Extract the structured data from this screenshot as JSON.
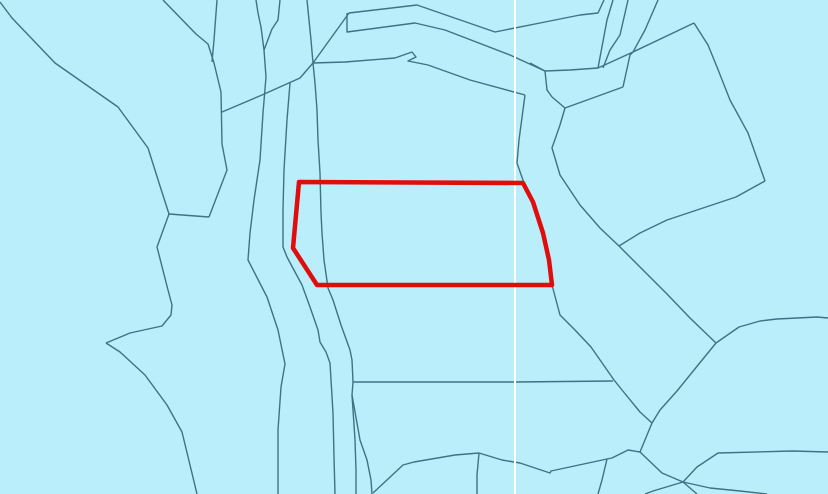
{
  "map": {
    "width": 828,
    "height": 494,
    "colors": {
      "water_background": "#b9eefa",
      "parcel_boundary": "#417284",
      "graticule_line": "#ffffff",
      "selected_parcel_outline": "#e00d0d"
    },
    "style": {
      "boundary_stroke_width": 1.4,
      "graticule_stroke_width": 2,
      "selected_stroke_width": 4.5
    },
    "graticule": {
      "type": "vertical-line",
      "x": 515,
      "y1": 0,
      "y2": 494
    },
    "selected_parcel": {
      "label": "highlighted-parcel",
      "points": [
        [
          299,
          182
        ],
        [
          523,
          183
        ],
        [
          533,
          202
        ],
        [
          543,
          233
        ],
        [
          549,
          260
        ],
        [
          552,
          285
        ],
        [
          317,
          285
        ],
        [
          293,
          248
        ]
      ]
    },
    "boundary_lines": [
      [
        [
          0,
          2
        ],
        [
          12,
          18
        ],
        [
          55,
          63
        ],
        [
          118,
          107
        ],
        [
          148,
          148
        ],
        [
          160,
          186
        ],
        [
          169,
          214
        ]
      ],
      [
        [
          169,
          214
        ],
        [
          209,
          217
        ]
      ],
      [
        [
          163,
          0
        ],
        [
          196,
          34
        ],
        [
          208,
          44
        ],
        [
          214,
          63
        ],
        [
          221,
          92
        ],
        [
          222,
          144
        ],
        [
          227,
          170
        ],
        [
          209,
          217
        ]
      ],
      [
        [
          217,
          0
        ],
        [
          214,
          40
        ],
        [
          212,
          62
        ]
      ],
      [
        [
          169,
          214
        ],
        [
          157,
          247
        ],
        [
          168,
          290
        ],
        [
          172,
          305
        ],
        [
          171,
          315
        ],
        [
          162,
          326
        ],
        [
          130,
          333
        ],
        [
          106,
          343
        ]
      ],
      [
        [
          106,
          343
        ],
        [
          120,
          352
        ],
        [
          145,
          375
        ],
        [
          167,
          405
        ],
        [
          182,
          432
        ],
        [
          190,
          465
        ],
        [
          197,
          494
        ]
      ],
      [
        [
          256,
          0
        ],
        [
          258,
          13
        ],
        [
          261,
          27
        ],
        [
          264,
          50
        ],
        [
          266,
          77
        ],
        [
          263,
          113
        ],
        [
          260,
          160
        ],
        [
          254,
          200
        ],
        [
          250,
          233
        ],
        [
          248,
          260
        ],
        [
          267,
          297
        ],
        [
          278,
          330
        ],
        [
          285,
          364
        ],
        [
          281,
          387
        ],
        [
          278,
          430
        ],
        [
          278,
          494
        ]
      ],
      [
        [
          280,
          0
        ],
        [
          278,
          20
        ],
        [
          272,
          29
        ],
        [
          264,
          50
        ]
      ],
      [
        [
          307,
          0
        ],
        [
          311,
          40
        ],
        [
          313,
          63
        ],
        [
          315,
          83
        ],
        [
          317,
          110
        ],
        [
          318,
          140
        ],
        [
          320,
          173
        ],
        [
          321,
          213
        ],
        [
          322,
          233
        ],
        [
          324,
          260
        ],
        [
          328,
          288
        ],
        [
          333,
          300
        ],
        [
          341,
          325
        ],
        [
          350,
          350
        ],
        [
          352,
          360
        ],
        [
          353,
          382
        ],
        [
          352,
          395
        ],
        [
          355,
          440
        ],
        [
          356,
          470
        ],
        [
          356,
          494
        ]
      ],
      [
        [
          352,
          395
        ],
        [
          360,
          440
        ],
        [
          367,
          460
        ],
        [
          371,
          480
        ],
        [
          372,
          494
        ]
      ],
      [
        [
          290,
          83
        ],
        [
          287,
          120
        ],
        [
          284,
          170
        ],
        [
          283,
          210
        ],
        [
          283,
          247
        ],
        [
          287,
          257
        ],
        [
          295,
          272
        ],
        [
          302,
          285
        ],
        [
          310,
          307
        ],
        [
          318,
          330
        ],
        [
          320,
          342
        ],
        [
          326,
          352
        ],
        [
          330,
          363
        ],
        [
          333,
          413
        ],
        [
          334,
          457
        ],
        [
          335,
          494
        ]
      ],
      [
        [
          222,
          112
        ],
        [
          262,
          95
        ],
        [
          300,
          78
        ],
        [
          313,
          63
        ],
        [
          349,
          13
        ],
        [
          417,
          5
        ],
        [
          495,
          32
        ],
        [
          540,
          23
        ],
        [
          580,
          15
        ],
        [
          598,
          13
        ],
        [
          604,
          0
        ]
      ],
      [
        [
          347,
          13
        ],
        [
          347,
          32
        ],
        [
          415,
          23
        ],
        [
          445,
          30
        ],
        [
          510,
          55
        ],
        [
          545,
          71
        ]
      ],
      [
        [
          545,
          71
        ],
        [
          570,
          70
        ],
        [
          598,
          68
        ]
      ],
      [
        [
          313,
          63
        ],
        [
          345,
          62
        ],
        [
          395,
          58
        ],
        [
          412,
          52
        ],
        [
          416,
          57
        ],
        [
          408,
          61
        ],
        [
          428,
          65
        ],
        [
          470,
          80
        ],
        [
          525,
          95
        ]
      ],
      [
        [
          525,
          95
        ],
        [
          519,
          140
        ],
        [
          517,
          163
        ],
        [
          524,
          183
        ],
        [
          533,
          205
        ],
        [
          543,
          237
        ],
        [
          550,
          262
        ],
        [
          552,
          285
        ]
      ],
      [
        [
          552,
          285
        ],
        [
          560,
          315
        ],
        [
          575,
          330
        ],
        [
          591,
          347
        ],
        [
          614,
          380
        ],
        [
          622,
          390
        ],
        [
          640,
          412
        ],
        [
          652,
          423
        ]
      ],
      [
        [
          530,
          63
        ],
        [
          545,
          71
        ]
      ],
      [
        [
          545,
          71
        ],
        [
          547,
          90
        ],
        [
          552,
          97
        ]
      ],
      [
        [
          552,
          97
        ],
        [
          565,
          108
        ]
      ],
      [
        [
          565,
          108
        ],
        [
          623,
          87
        ]
      ],
      [
        [
          623,
          87
        ],
        [
          630,
          55
        ],
        [
          633,
          52
        ]
      ],
      [
        [
          598,
          68
        ],
        [
          633,
          52
        ],
        [
          694,
          23
        ]
      ],
      [
        [
          613,
          0
        ],
        [
          607,
          20
        ],
        [
          598,
          68
        ]
      ],
      [
        [
          628,
          0
        ],
        [
          620,
          35
        ],
        [
          610,
          50
        ],
        [
          603,
          68
        ]
      ],
      [
        [
          658,
          0
        ],
        [
          645,
          30
        ],
        [
          633,
          52
        ]
      ],
      [
        [
          565,
          108
        ],
        [
          560,
          125
        ],
        [
          552,
          148
        ],
        [
          560,
          175
        ],
        [
          580,
          205
        ],
        [
          600,
          228
        ],
        [
          619,
          246
        ]
      ],
      [
        [
          694,
          23
        ],
        [
          708,
          45
        ],
        [
          717,
          67
        ],
        [
          730,
          100
        ],
        [
          748,
          133
        ],
        [
          765,
          181
        ]
      ],
      [
        [
          765,
          181
        ],
        [
          736,
          197
        ],
        [
          700,
          209
        ],
        [
          667,
          220
        ],
        [
          640,
          233
        ],
        [
          619,
          246
        ]
      ],
      [
        [
          619,
          246
        ],
        [
          645,
          272
        ],
        [
          667,
          294
        ],
        [
          690,
          318
        ],
        [
          716,
          343
        ]
      ],
      [
        [
          716,
          343
        ],
        [
          739,
          327
        ],
        [
          760,
          321
        ],
        [
          777,
          319
        ],
        [
          817,
          317
        ],
        [
          828,
          318
        ]
      ],
      [
        [
          716,
          343
        ],
        [
          694,
          370
        ],
        [
          677,
          391
        ],
        [
          660,
          410
        ],
        [
          652,
          423
        ]
      ],
      [
        [
          652,
          423
        ],
        [
          640,
          452
        ]
      ],
      [
        [
          640,
          452
        ],
        [
          628,
          450
        ],
        [
          612,
          458
        ],
        [
          607,
          459
        ],
        [
          551,
          471
        ],
        [
          550,
          473
        ],
        [
          520,
          463
        ],
        [
          502,
          460
        ],
        [
          479,
          453
        ]
      ],
      [
        [
          479,
          453
        ],
        [
          455,
          455
        ],
        [
          414,
          462
        ],
        [
          403,
          465
        ],
        [
          373,
          493
        ]
      ],
      [
        [
          479,
          453
        ],
        [
          477,
          475
        ],
        [
          477,
          494
        ]
      ],
      [
        [
          607,
          459
        ],
        [
          602,
          480
        ],
        [
          598,
          494
        ]
      ],
      [
        [
          640,
          452
        ],
        [
          662,
          473
        ],
        [
          683,
          482
        ],
        [
          697,
          494
        ]
      ],
      [
        [
          828,
          452
        ],
        [
          792,
          451
        ],
        [
          718,
          453
        ],
        [
          697,
          467
        ],
        [
          683,
          482
        ],
        [
          653,
          491
        ],
        [
          645,
          494
        ]
      ],
      [
        [
          683,
          482
        ],
        [
          710,
          488
        ],
        [
          740,
          491
        ],
        [
          767,
          494
        ]
      ],
      [
        [
          353,
          382
        ],
        [
          450,
          382
        ],
        [
          515,
          382
        ],
        [
          613,
          381
        ]
      ]
    ]
  }
}
